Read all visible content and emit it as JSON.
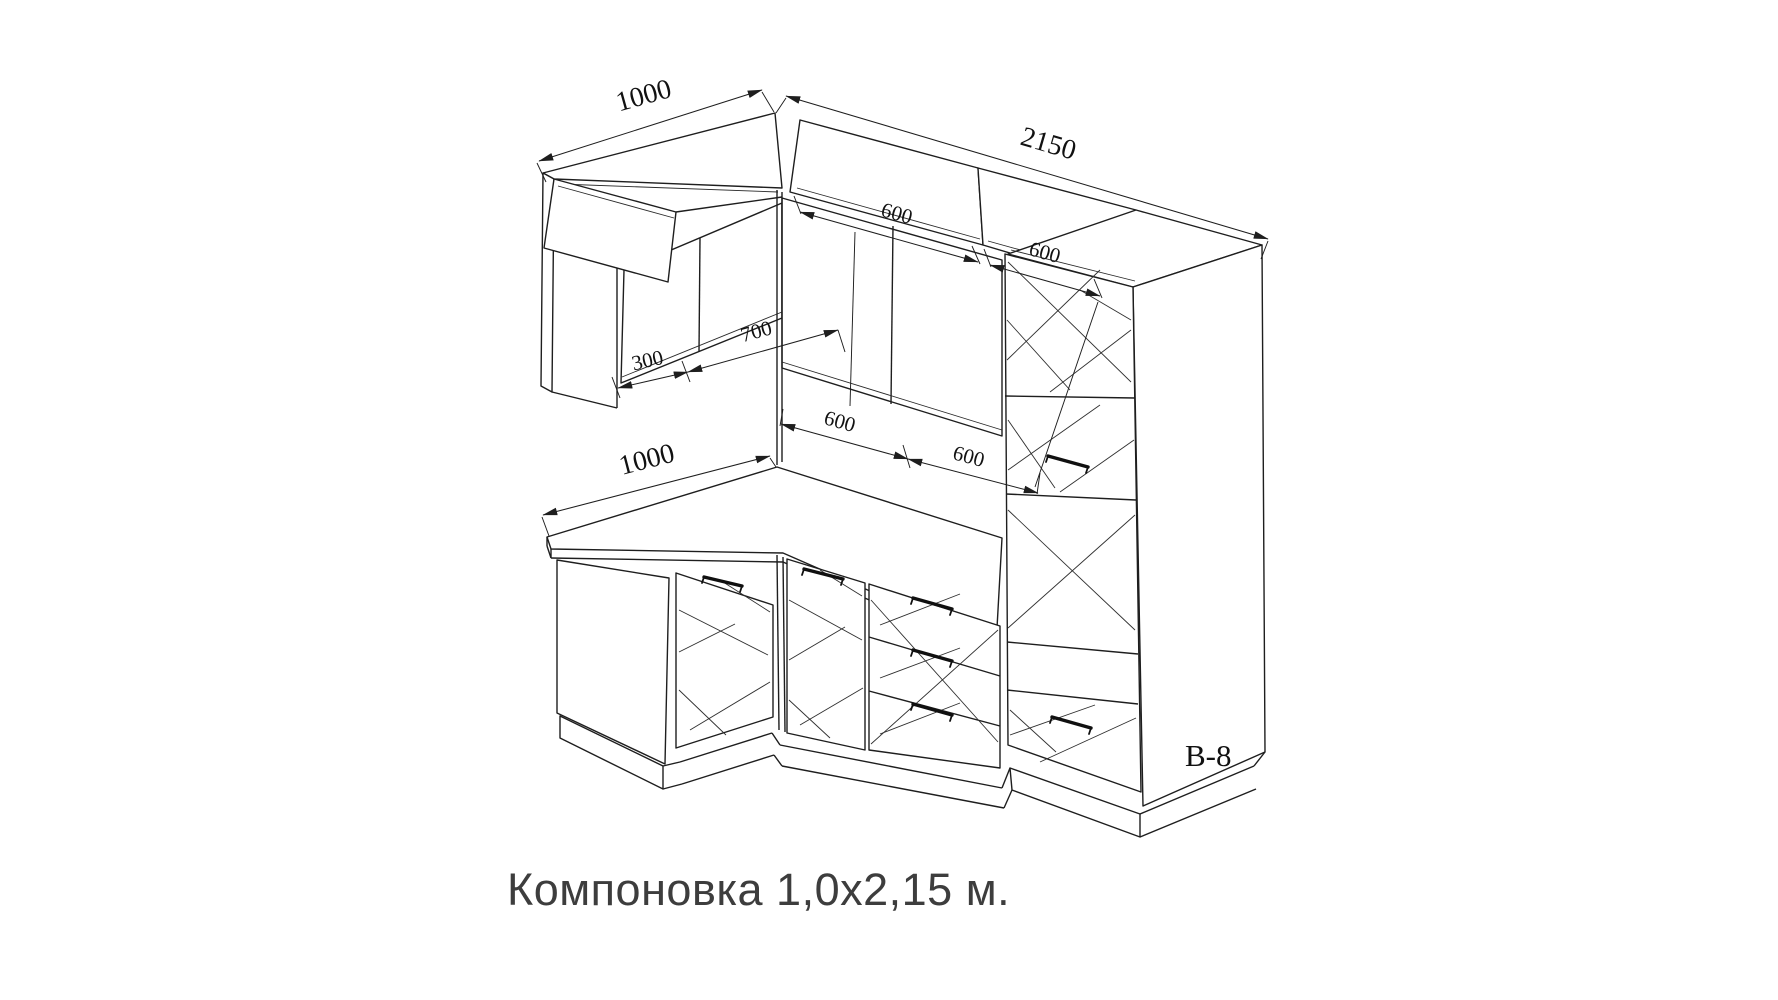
{
  "drawing": {
    "caption": "Компоновка 1,0х2,15 м.",
    "model_label": "В-8",
    "dimensions": {
      "upper_left_width": "1000",
      "right_total_width": "2150",
      "upper_cabinet_1": "600",
      "upper_cabinet_2": "600",
      "left_depth": "300",
      "left_span": "700",
      "mid_cabinet_1": "600",
      "mid_cabinet_2": "600",
      "counter_left_width": "1000"
    },
    "colors": {
      "line": "#1e1e1e",
      "background": "#ffffff",
      "caption_text": "#3d3d3d"
    }
  }
}
